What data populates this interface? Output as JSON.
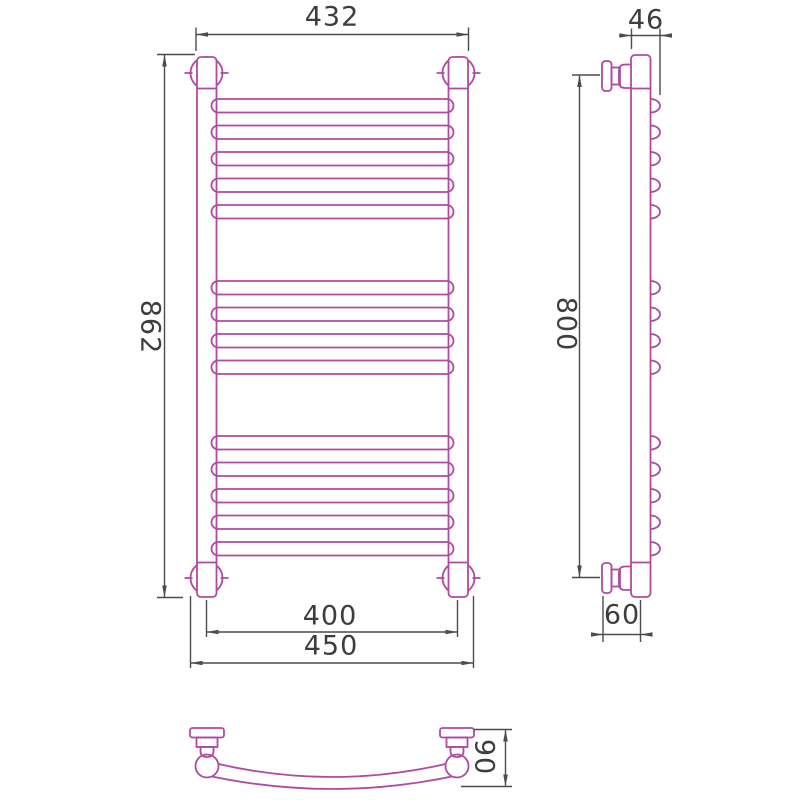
{
  "drawing_type": "heated towel rail - three-view technical drawing",
  "colors": {
    "drawing_stroke": "#b04aa0",
    "dimension_stroke": "#4c4c4c",
    "text": "#3d3d3d",
    "background": "#ffffff"
  },
  "structure": {
    "rung_groups": [
      5,
      4,
      5
    ],
    "rung_total": 14
  },
  "dims": {
    "w432": "432",
    "h862": "862",
    "w400": "400",
    "w450": "450",
    "d46": "46",
    "h800": "800",
    "d60": "60",
    "d90": "90"
  }
}
